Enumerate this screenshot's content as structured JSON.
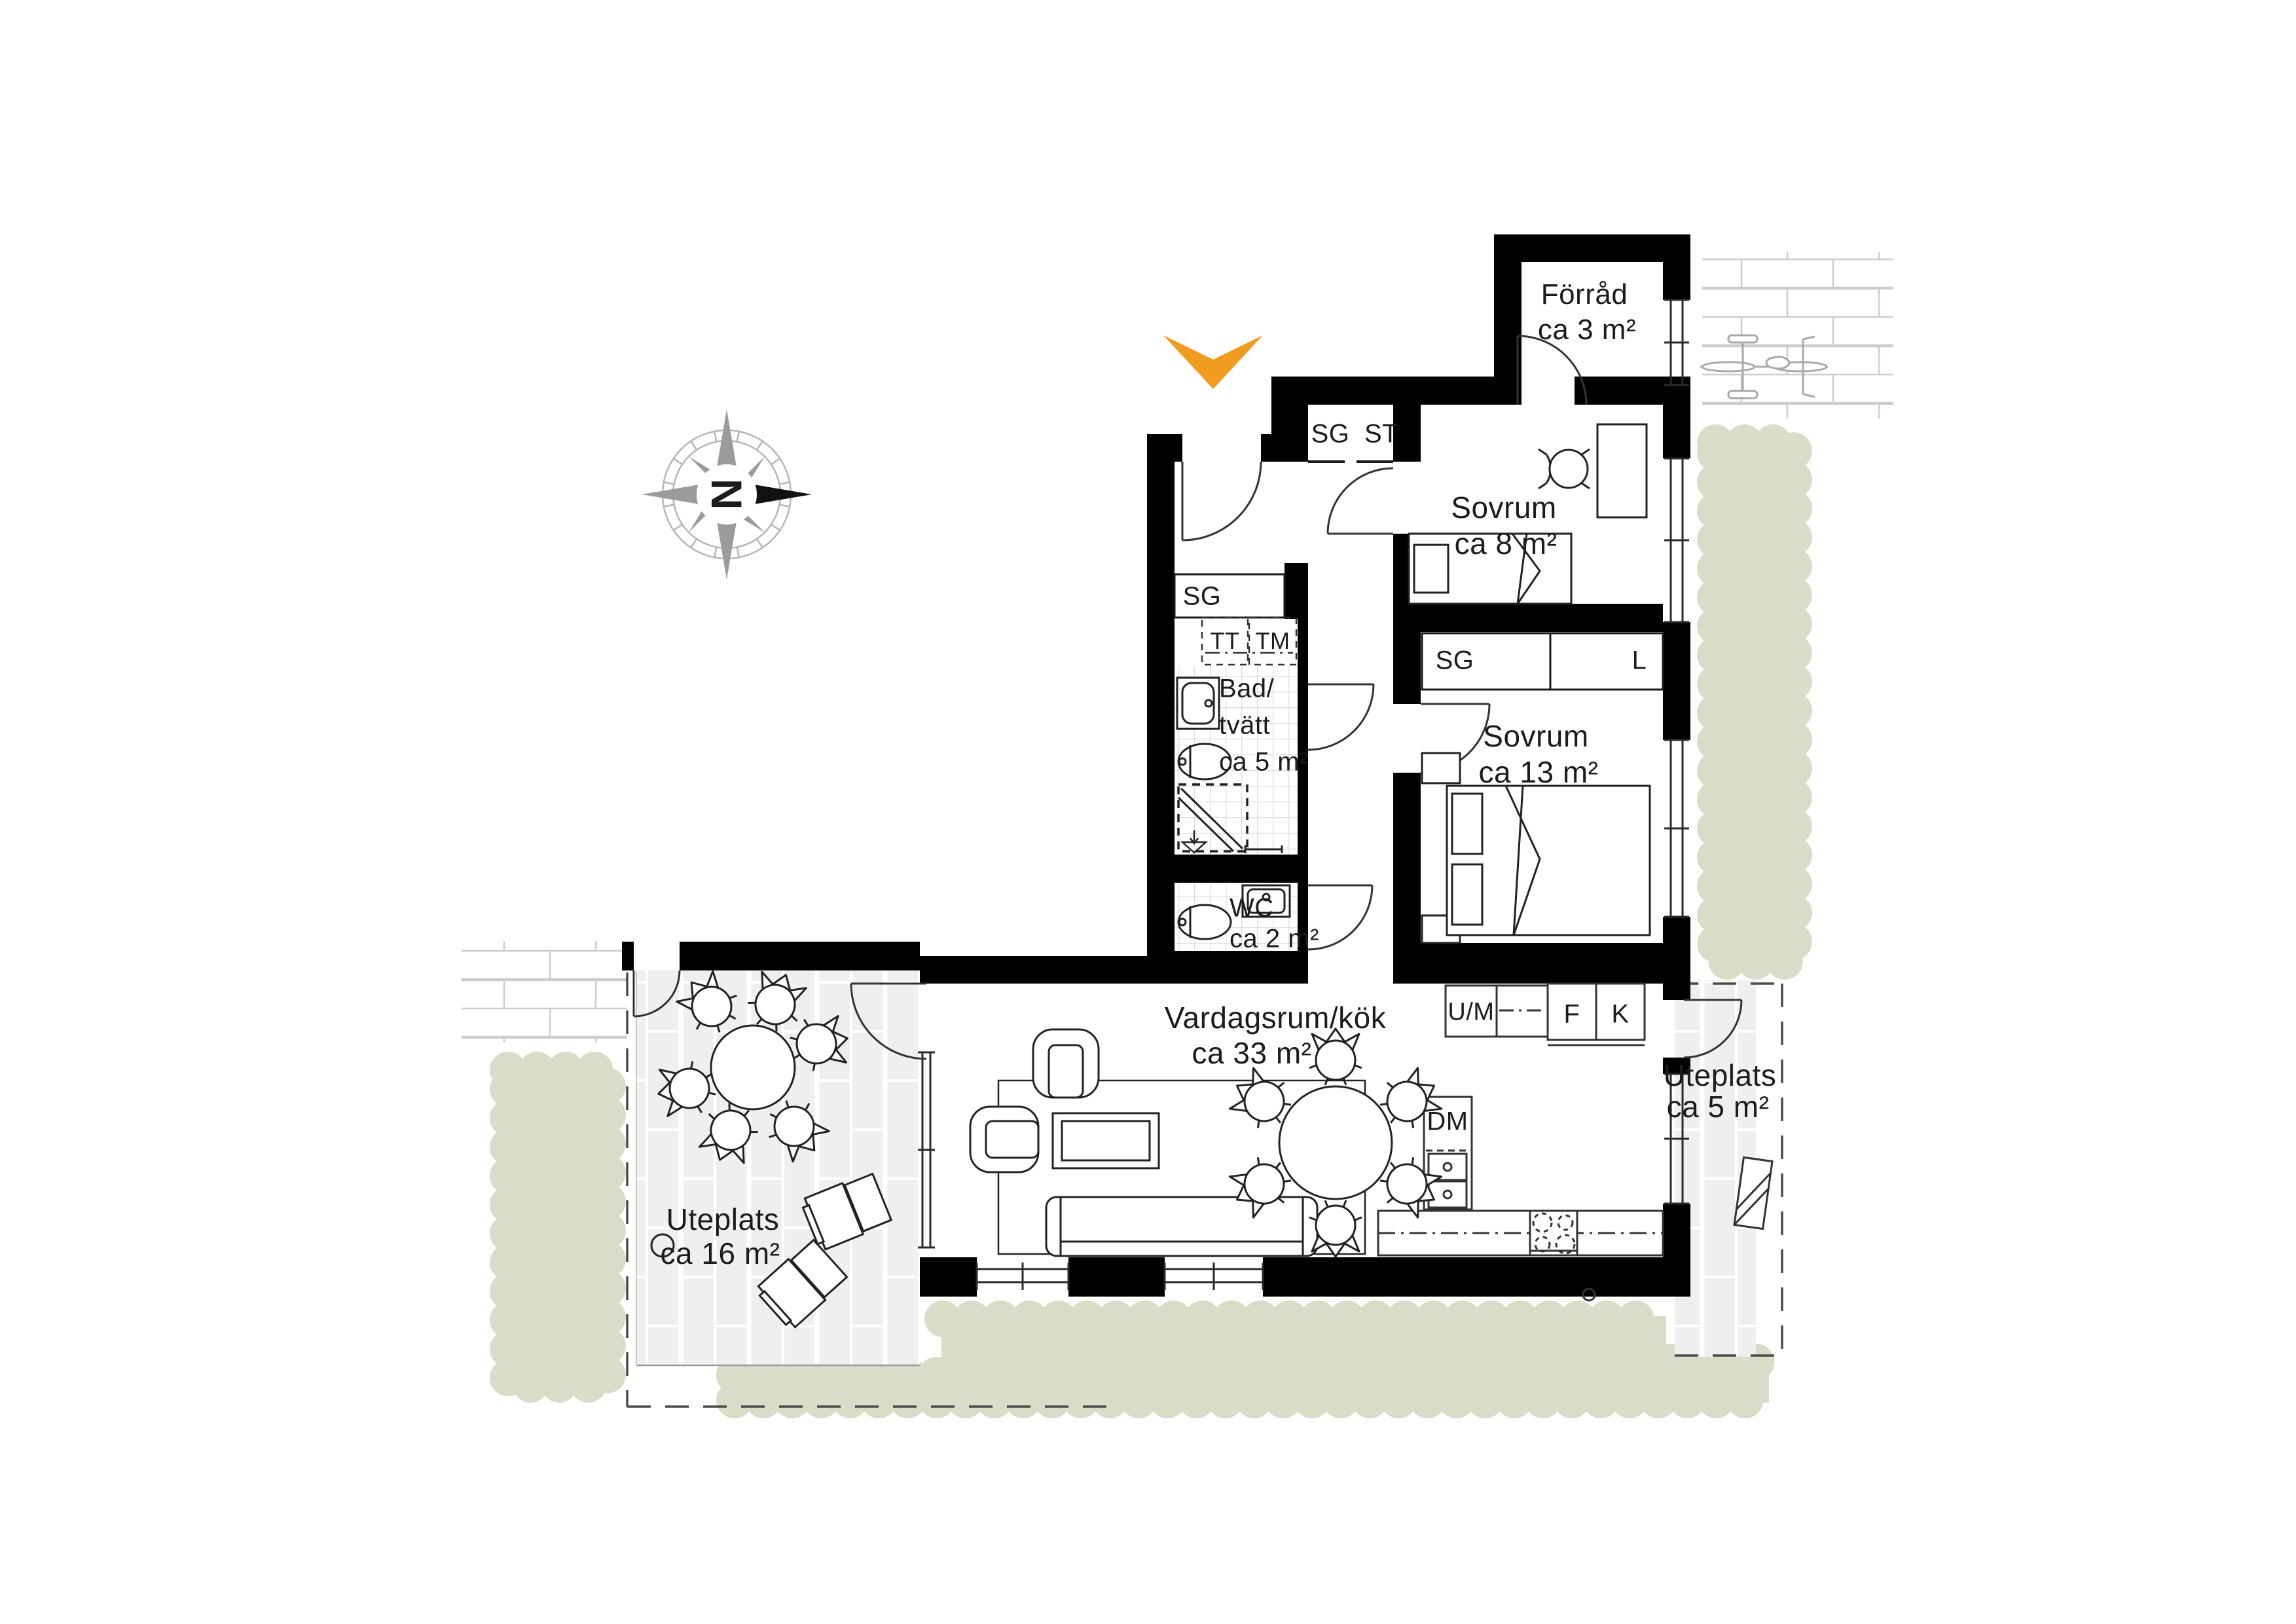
{
  "plan": {
    "compass": {
      "north_label": "N"
    },
    "rooms": {
      "forrad": {
        "name": "Förråd",
        "area": "ca 3 m²"
      },
      "sovrum8": {
        "name": "Sovrum",
        "area": "ca 8 m²"
      },
      "sovrum13": {
        "name": "Sovrum",
        "area": "ca 13 m²"
      },
      "bad_tvatt": {
        "line1": "Bad/",
        "line2": "tvätt",
        "area": "ca 5 m²"
      },
      "wc": {
        "name": "WC",
        "area": "ca 2 m²"
      },
      "vardagsrum": {
        "name": "Vardagsrum/kök",
        "area": "ca 33 m²"
      }
    },
    "outdoor": {
      "uteplats_large": {
        "name": "Uteplats",
        "area": "ca 16 m²"
      },
      "uteplats_small": {
        "name": "Uteplats",
        "area": "ca 5 m²"
      }
    },
    "closets": {
      "hall_top_left": "SG",
      "hall_top_right": "ST",
      "hall": "SG",
      "bedroom_left": "SG",
      "bedroom_right": "L"
    },
    "laundry": {
      "dryer": "TT",
      "washer": "TM"
    },
    "kitchen": {
      "oven_micro": "U/M",
      "freezer": "F",
      "fridge": "K",
      "dishwasher": "DM"
    },
    "colors": {
      "entrance_arrow": "#F29C1F",
      "hedge_green": "#D9DDC8",
      "terrace_tile": "#EFEFED",
      "wall_black": "#000000"
    }
  }
}
